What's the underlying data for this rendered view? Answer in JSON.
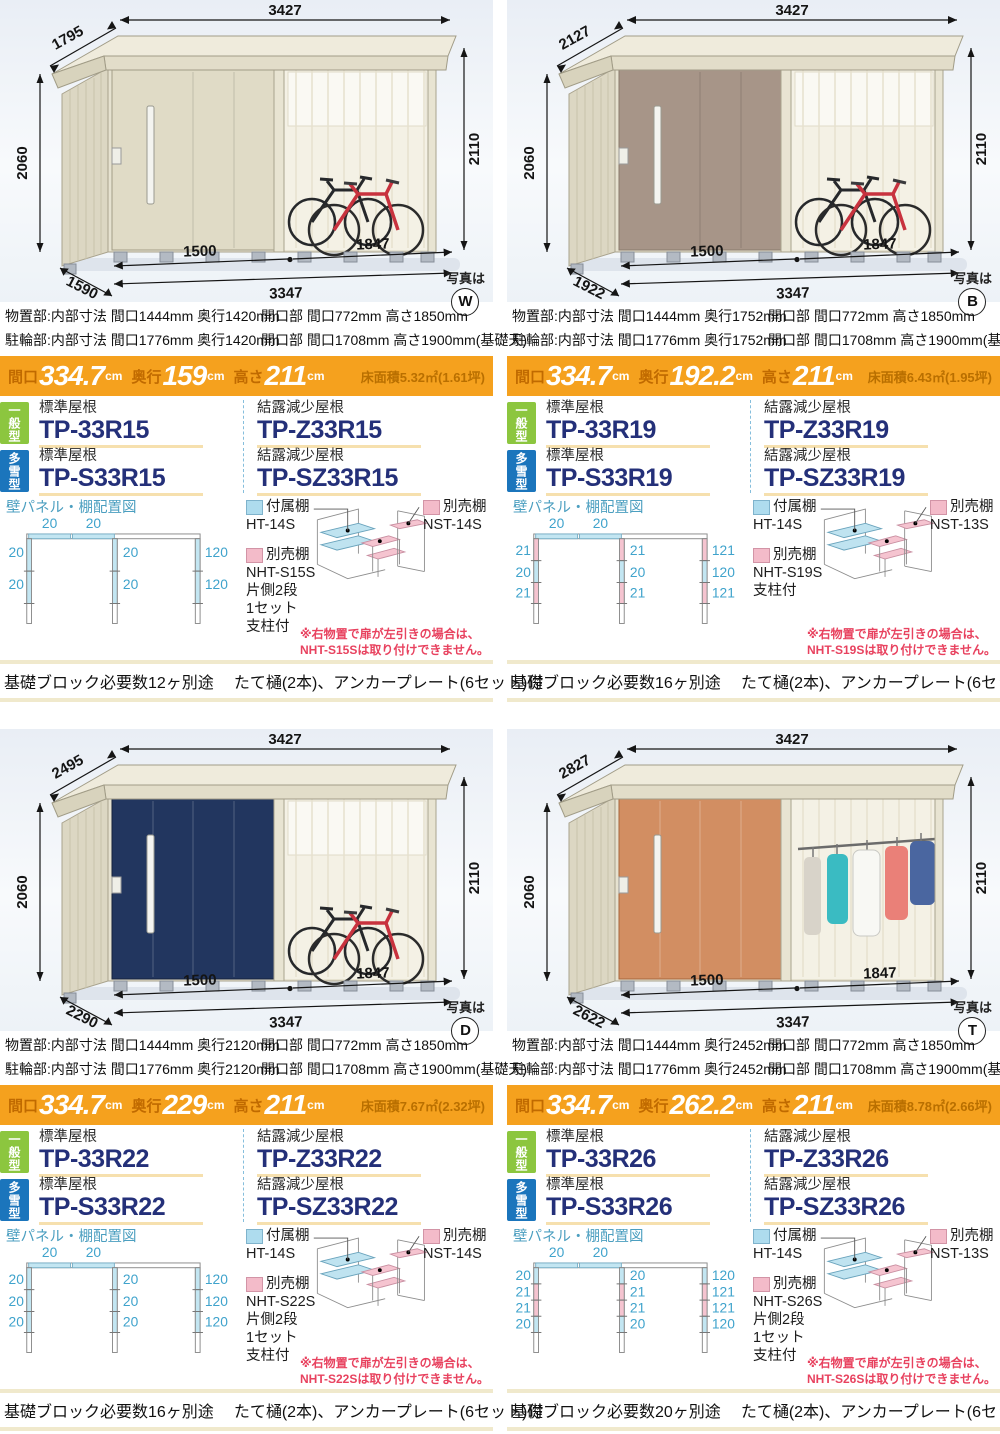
{
  "labels": {
    "photo_caption": "写真は",
    "wall_title": "壁パネル・棚配置図",
    "included_shelf": "付属棚",
    "optional_shelf": "別売棚",
    "general_type": "一般型",
    "snow_type": "多雪型",
    "std_roof": "標準屋根",
    "dew_roof": "結露減少屋根",
    "maguchi": "間口",
    "okuyuki": "奥行",
    "takasa": "高さ",
    "cm": "cm"
  },
  "colors": {
    "accent_orange": "#F5A11E",
    "badge_green": "#8CC63F",
    "badge_blue": "#1B75BC",
    "model_navy": "#243079",
    "warning_red": "#E8425F",
    "diagram_blue": "#C3E6F2",
    "diagram_pink": "#F5C4D0",
    "swatch_blue": "#AEDCEE",
    "swatch_pink": "#F3BBC9"
  },
  "panels": [
    {
      "photo_letter": "W",
      "door_color": "#E0DBC6",
      "dims": {
        "depth_top": "1795",
        "width": "3427",
        "h_left": "2060",
        "h_right": "2110",
        "door_w": "1500",
        "bay_w": "1847",
        "total_w": "3347",
        "depth_bottom": "1590"
      },
      "spec": {
        "storage_left": "物置部:内部寸法 間口1444mm 奥行1420mm",
        "storage_right": "開口部 間口772mm 高さ1850mm",
        "bike_left": "駐輪部:内部寸法 間口1776mm 奥行1420mm",
        "bike_right": "開口部 間口1708mm 高さ1900mm(基礎天)"
      },
      "banner": {
        "maguchi": "334.7",
        "okuyuki": "159",
        "takasa": "211",
        "floor": "床面積5.32㎡(1.61坪)"
      },
      "models": {
        "std_general": "TP-33R15",
        "dew_general": "TP-Z33R15",
        "std_snow": "TP-S33R15",
        "dew_snow": "TP-SZ33R15"
      },
      "shelf": {
        "included_model": "HT-14S",
        "optional_right_model": "NST-14S",
        "optional_left_model": "NHT-S15S",
        "optional_left_lines": [
          "片側2段",
          "1セット",
          "支柱付"
        ],
        "warning1": "※右物置で扉が左引きの場合は、",
        "warning2": "NHT-S15Sは取り付けできません。"
      },
      "diagram": {
        "top": [
          "20",
          "20"
        ],
        "rows": [
          {
            "left": "20",
            "mid": "20",
            "right": "120",
            "color": "#C3E6F2"
          },
          {
            "left": "20",
            "mid": "20",
            "right": "120",
            "color": "#C3E6F2"
          }
        ]
      },
      "footer": {
        "blocks": "基礎ブロック必要数12ヶ別途",
        "extras": "たて樋(2本)、アンカープレート(6セット)付"
      }
    },
    {
      "photo_letter": "B",
      "door_color": "#A79588",
      "dims": {
        "depth_top": "2127",
        "width": "3427",
        "h_left": "2060",
        "h_right": "2110",
        "door_w": "1500",
        "bay_w": "1847",
        "total_w": "3347",
        "depth_bottom": "1922"
      },
      "spec": {
        "storage_left": "物置部:内部寸法 間口1444mm 奥行1752mm",
        "storage_right": "開口部 間口772mm 高さ1850mm",
        "bike_left": "駐輪部:内部寸法 間口1776mm 奥行1752mm",
        "bike_right": "開口部 間口1708mm 高さ1900mm(基礎天)"
      },
      "banner": {
        "maguchi": "334.7",
        "okuyuki": "192.2",
        "takasa": "211",
        "floor": "床面積6.43㎡(1.95坪)"
      },
      "models": {
        "std_general": "TP-33R19",
        "dew_general": "TP-Z33R19",
        "std_snow": "TP-S33R19",
        "dew_snow": "TP-SZ33R19"
      },
      "shelf": {
        "included_model": "HT-14S",
        "optional_right_model": "NST-13S",
        "optional_left_model": "NHT-S19S",
        "optional_left_lines": [
          "支柱付"
        ],
        "warning1": "※右物置で扉が左引きの場合は、",
        "warning2": "NHT-S19Sは取り付けできません。"
      },
      "diagram": {
        "top": [
          "20",
          "20"
        ],
        "rows": [
          {
            "left": "21",
            "mid": "21",
            "right": "121",
            "color": "#F5C4D0"
          },
          {
            "left": "20",
            "mid": "20",
            "right": "120",
            "color": "#C3E6F2"
          },
          {
            "left": "21",
            "mid": "21",
            "right": "121",
            "color": "#F5C4D0"
          }
        ]
      },
      "footer": {
        "blocks": "基礎ブロック必要数16ヶ別途",
        "extras": "たて樋(2本)、アンカープレート(6セット)付"
      }
    },
    {
      "photo_letter": "D",
      "door_color": "#22365F",
      "dims": {
        "depth_top": "2495",
        "width": "3427",
        "h_left": "2060",
        "h_right": "2110",
        "door_w": "1500",
        "bay_w": "1847",
        "total_w": "3347",
        "depth_bottom": "2290"
      },
      "spec": {
        "storage_left": "物置部:内部寸法 間口1444mm 奥行2120mm",
        "storage_right": "開口部 間口772mm 高さ1850mm",
        "bike_left": "駐輪部:内部寸法 間口1776mm 奥行2120mm",
        "bike_right": "開口部 間口1708mm 高さ1900mm(基礎天)"
      },
      "banner": {
        "maguchi": "334.7",
        "okuyuki": "229",
        "takasa": "211",
        "floor": "床面積7.67㎡(2.32坪)"
      },
      "models": {
        "std_general": "TP-33R22",
        "dew_general": "TP-Z33R22",
        "std_snow": "TP-S33R22",
        "dew_snow": "TP-SZ33R22"
      },
      "shelf": {
        "included_model": "HT-14S",
        "optional_right_model": "NST-14S",
        "optional_left_model": "NHT-S22S",
        "optional_left_lines": [
          "片側2段",
          "1セット",
          "支柱付"
        ],
        "warning1": "※右物置で扉が左引きの場合は、",
        "warning2": "NHT-S22Sは取り付けできません。"
      },
      "diagram": {
        "top": [
          "20",
          "20"
        ],
        "rows": [
          {
            "left": "20",
            "mid": "20",
            "right": "120",
            "color": "#C3E6F2"
          },
          {
            "left": "20",
            "mid": "20",
            "right": "120",
            "color": "#C3E6F2"
          },
          {
            "left": "20",
            "mid": "20",
            "right": "120",
            "color": "#C3E6F2"
          }
        ]
      },
      "footer": {
        "blocks": "基礎ブロック必要数16ヶ別途",
        "extras": "たて樋(2本)、アンカープレート(6セット)付"
      }
    },
    {
      "photo_letter": "T",
      "door_color": "#D28E62",
      "dims": {
        "depth_top": "2827",
        "width": "3427",
        "h_left": "2060",
        "h_right": "2110",
        "door_w": "1500",
        "bay_w": "1847",
        "total_w": "3347",
        "depth_bottom": "2622"
      },
      "spec": {
        "storage_left": "物置部:内部寸法 間口1444mm 奥行2452mm",
        "storage_right": "開口部 間口772mm 高さ1850mm",
        "bike_left": "駐輪部:内部寸法 間口1776mm 奥行2452mm",
        "bike_right": "開口部 間口1708mm 高さ1900mm(基礎天)"
      },
      "banner": {
        "maguchi": "334.7",
        "okuyuki": "262.2",
        "takasa": "211",
        "floor": "床面積8.78㎡(2.66坪)"
      },
      "models": {
        "std_general": "TP-33R26",
        "dew_general": "TP-Z33R26",
        "std_snow": "TP-S33R26",
        "dew_snow": "TP-SZ33R26"
      },
      "shelf": {
        "included_model": "HT-14S",
        "optional_right_model": "NST-13S",
        "optional_left_model": "NHT-S26S",
        "optional_left_lines": [
          "片側2段",
          "1セット",
          "支柱付"
        ],
        "warning1": "※右物置で扉が左引きの場合は、",
        "warning2": "NHT-S26Sは取り付けできません。"
      },
      "diagram": {
        "top": [
          "20",
          "20"
        ],
        "rows": [
          {
            "left": "20",
            "mid": "20",
            "right": "120",
            "color": "#C3E6F2"
          },
          {
            "left": "21",
            "mid": "21",
            "right": "121",
            "color": "#F5C4D0"
          },
          {
            "left": "21",
            "mid": "21",
            "right": "121",
            "color": "#F5C4D0"
          },
          {
            "left": "20",
            "mid": "20",
            "right": "120",
            "color": "#C3E6F2"
          }
        ]
      },
      "footer": {
        "blocks": "基礎ブロック必要数20ヶ別途",
        "extras": "たて樋(2本)、アンカープレート(6セット)付"
      }
    }
  ]
}
